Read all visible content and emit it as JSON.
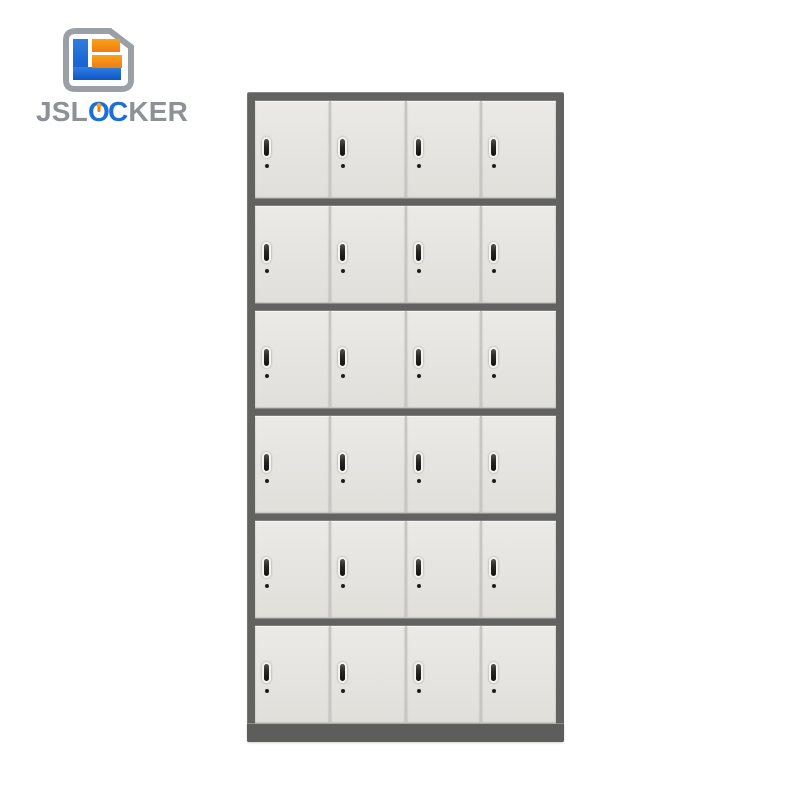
{
  "brand": {
    "logo_text": {
      "prefix": "JSL",
      "letter_o": "O",
      "letter_c": "C",
      "suffix": "KER",
      "full": "JSLOCKER"
    },
    "colors": {
      "text_gray": "#8d9196",
      "blue": "#1c6fd9",
      "blue_light": "#2f7de0",
      "blue_dark": "#0d57c9",
      "orange_light": "#fba019",
      "orange_dark": "#ef7d12",
      "icon_frame": "#9aa0a6"
    }
  },
  "locker": {
    "rows": 6,
    "columns": 4,
    "door_count": 24,
    "colors": {
      "frame": "#626260",
      "base": "#5d5d5b",
      "row_gap": "#c7c6c2",
      "door_light": "#ebeae6",
      "door_dark": "#e0dfda",
      "handle_outline": "#f4f3f0",
      "handle_slot": "#262622",
      "keyhole": "#1e1e1b"
    }
  }
}
